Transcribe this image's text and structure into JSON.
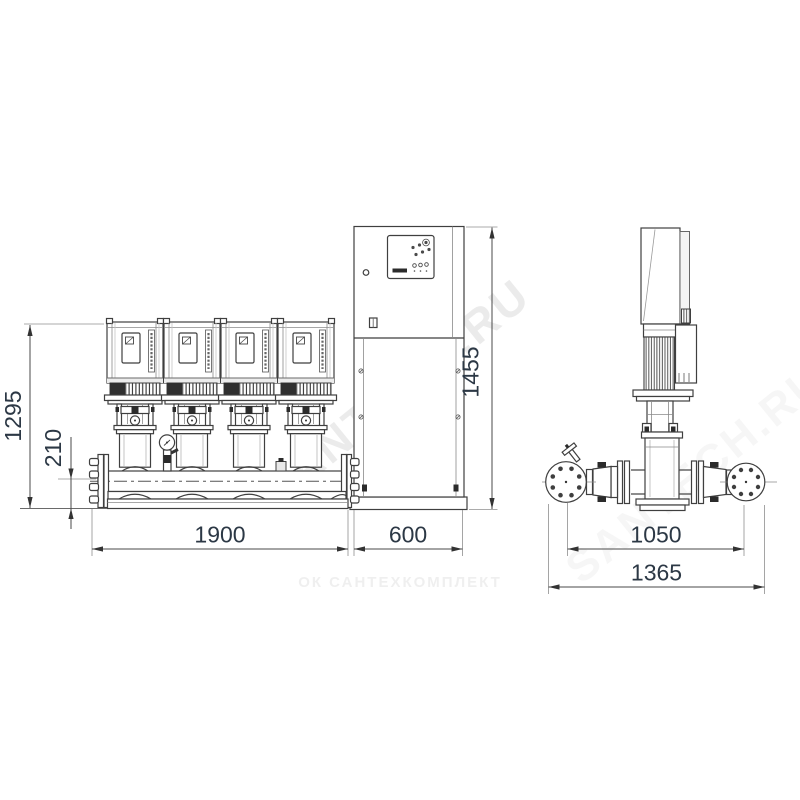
{
  "drawing": {
    "front_view": {
      "dim_total_height": "1295",
      "dim_manifold_height": "210",
      "dim_cabinet_height": "1455",
      "dim_pump_base_width": "1900",
      "dim_cabinet_width": "600"
    },
    "side_view": {
      "dim_flange_span": "1050",
      "dim_overall_depth": "1365"
    },
    "watermarks": {
      "diagonal_main": "SANTECH.RU",
      "diagonal_secondary": "SANTECH.RU",
      "footer": "ОК САНТЕХКОМПЛЕКТ"
    },
    "colors": {
      "line": "#3f3f3f",
      "dimension_text": "#2c3845",
      "watermark": "#8f8f8f"
    }
  }
}
